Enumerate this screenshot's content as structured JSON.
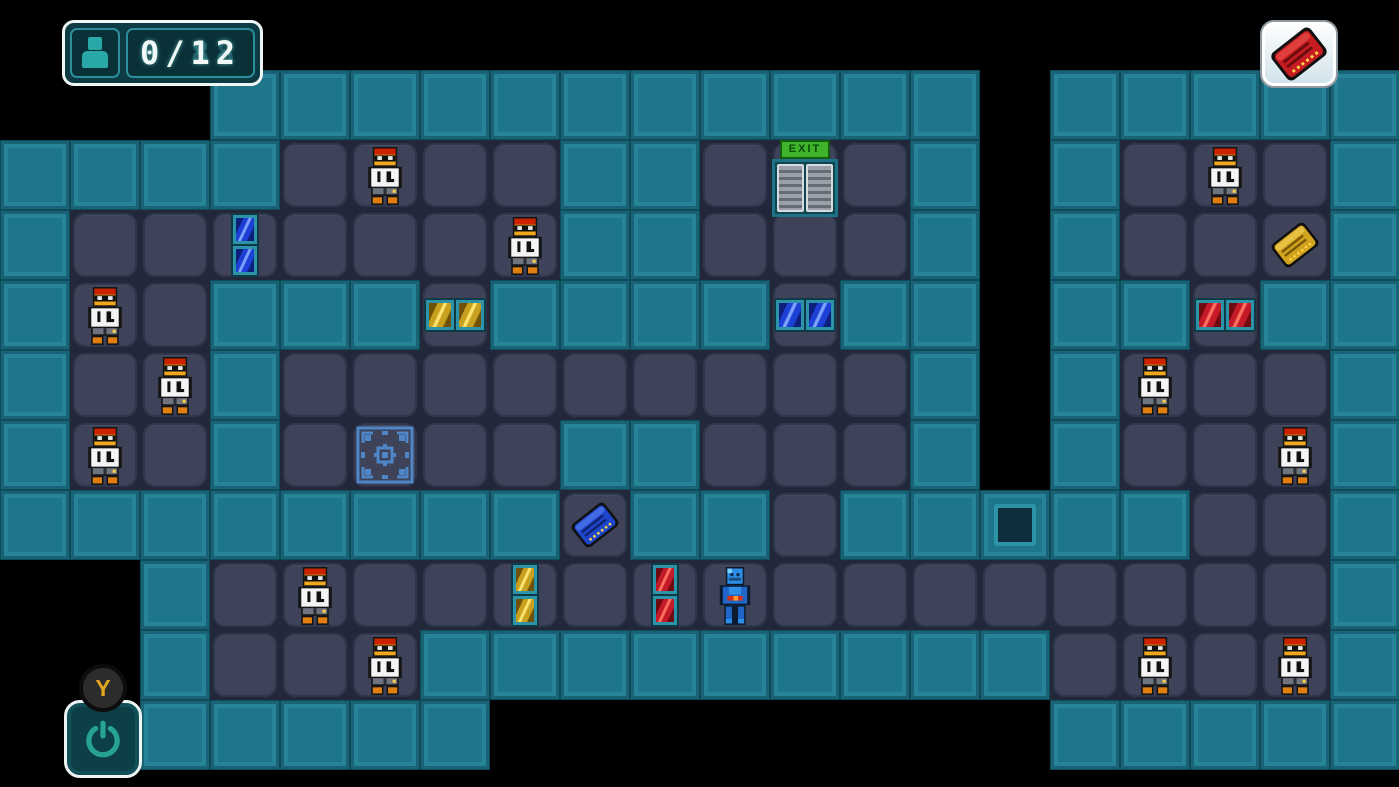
{
  "hud": {
    "rescued_counter": "0/12",
    "counter_ghost": "8/88",
    "restart_key_label": "Y",
    "inventory_keycard": "red"
  },
  "map": {
    "tile_size": 70,
    "exit_label": "EXIT",
    "grid": [
      "                    ",
      "   ########### #####",
      "####....##...# #...#",
      "#.......##...# #...#",
      "#..###.####.## ##.##",
      "#..#.........# #...#",
      "#..#....##...# #...#",
      "########.##.##P##..#",
      "  #................#",
      "  #...#########....#",
      "  #####        #####"
    ],
    "scientists": [
      [
        5,
        2
      ],
      [
        7,
        3
      ],
      [
        1,
        4
      ],
      [
        2,
        5
      ],
      [
        1,
        6
      ],
      [
        4,
        8
      ],
      [
        5,
        9
      ],
      [
        17,
        2
      ],
      [
        16,
        5
      ],
      [
        18,
        6
      ],
      [
        16,
        9
      ],
      [
        18,
        9
      ]
    ],
    "player_cell": [
      10,
      8
    ],
    "exit_cell": [
      11,
      2
    ],
    "pad_cell": [
      5,
      6
    ],
    "keycards": [
      {
        "color": "blue",
        "cell": [
          8,
          7
        ]
      },
      {
        "color": "gold",
        "cell": [
          18,
          3
        ]
      }
    ],
    "doors": [
      {
        "color": "blue",
        "orient": "v",
        "cell": [
          3,
          3
        ]
      },
      {
        "color": "gold",
        "orient": "h",
        "cell": [
          6,
          4
        ]
      },
      {
        "color": "blue",
        "orient": "h",
        "cell": [
          11,
          4
        ]
      },
      {
        "color": "red",
        "orient": "h",
        "cell": [
          17,
          4
        ]
      },
      {
        "color": "gold",
        "orient": "v",
        "cell": [
          7,
          8
        ]
      },
      {
        "color": "red",
        "orient": "v",
        "cell": [
          9,
          8
        ]
      }
    ]
  },
  "colors": {
    "background": "#000000",
    "wall": "#1f7589",
    "wall_dark": "#0e4a57",
    "wall_light": "#39aac0",
    "floor": "#3e4359",
    "floor_gap": "#23273a",
    "hud_teal": "#2aa8a8",
    "exit_green": "#3fb32a",
    "card_colors": {
      "red": {
        "body": "#c41c20",
        "dark": "#6e0d10",
        "light": "#ff6a60"
      },
      "blue": {
        "body": "#1e46cc",
        "dark": "#0e2470",
        "light": "#6f9aff"
      },
      "gold": {
        "body": "#d2a41e",
        "dark": "#7a5a08",
        "light": "#ffe470"
      }
    },
    "door_colors": {
      "blue": {
        "body": "#1c3fd6",
        "dark": "#0c1f7a",
        "light": "#7fa4ff"
      },
      "gold": {
        "body": "#c8a020",
        "dark": "#6e5208",
        "light": "#ffe470"
      },
      "red": {
        "body": "#c41a28",
        "dark": "#6e0a12",
        "light": "#ff7060"
      }
    }
  }
}
